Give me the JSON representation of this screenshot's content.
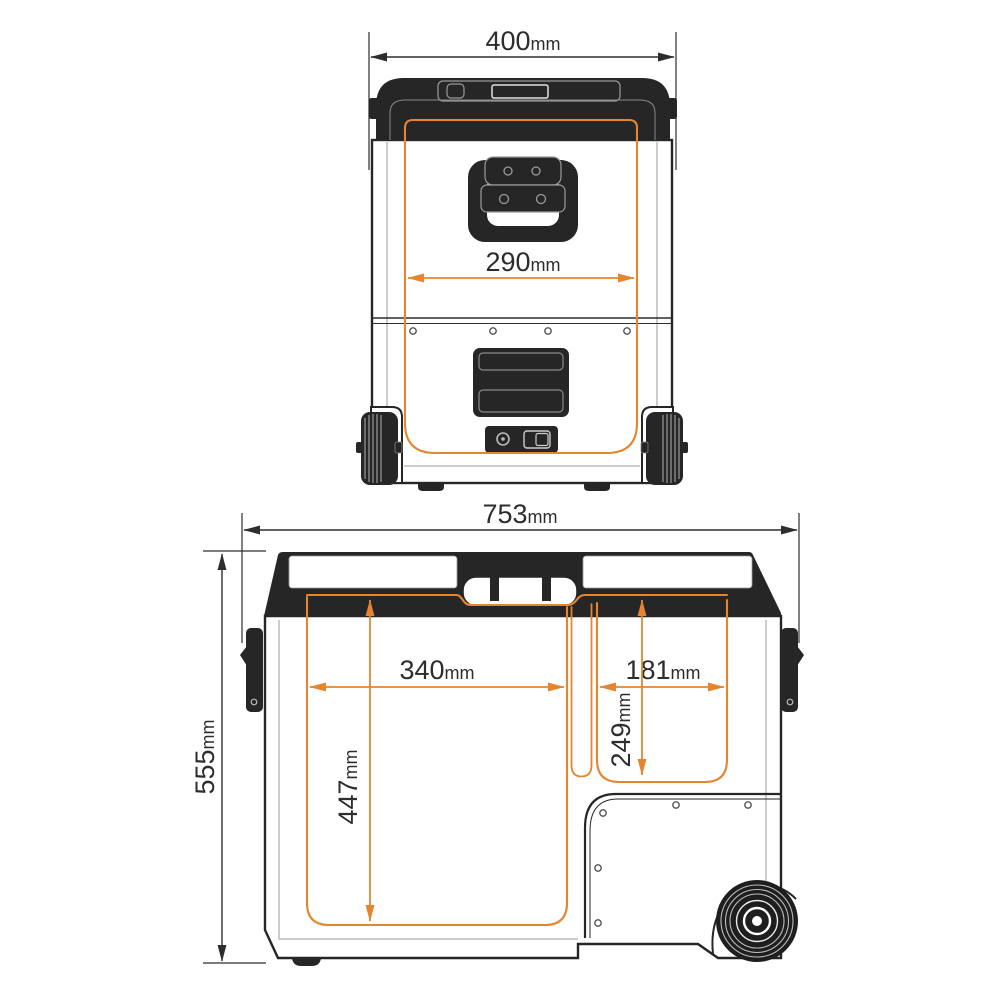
{
  "diagram": {
    "type": "technical-drawing",
    "colors": {
      "outline_dark": "#262626",
      "dimension_orange": "#E5852F",
      "text_dark": "#2d2d2d",
      "detail_gray": "#9a9a9a",
      "background": "#ffffff"
    },
    "front_view": {
      "dimensions": {
        "overall_width": {
          "value": "400",
          "unit": "mm"
        },
        "inner_width": {
          "value": "290",
          "unit": "mm"
        }
      }
    },
    "side_view": {
      "dimensions": {
        "overall_width": {
          "value": "753",
          "unit": "mm"
        },
        "overall_height": {
          "value": "555",
          "unit": "mm"
        },
        "left_compartment_width": {
          "value": "340",
          "unit": "mm"
        },
        "left_compartment_depth": {
          "value": "447",
          "unit": "mm"
        },
        "right_compartment_width": {
          "value": "181",
          "unit": "mm"
        },
        "right_compartment_depth": {
          "value": "249",
          "unit": "mm"
        }
      }
    }
  }
}
